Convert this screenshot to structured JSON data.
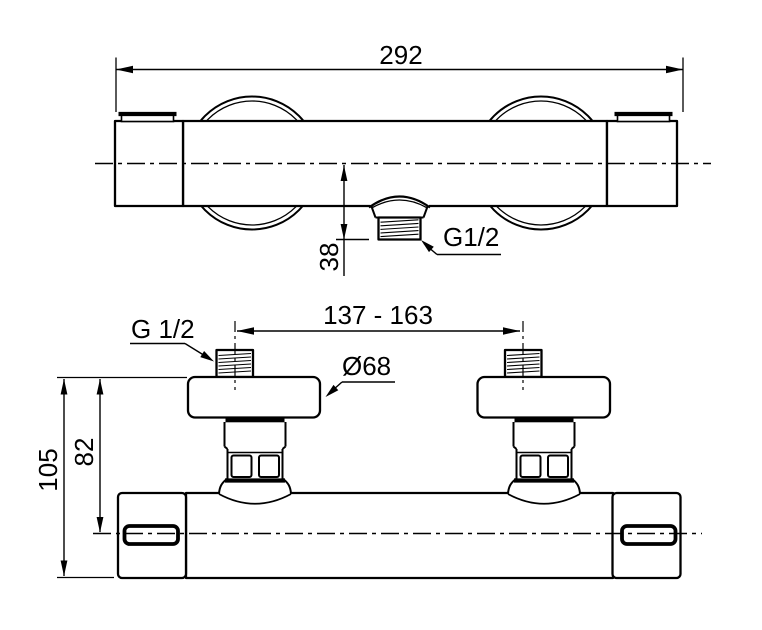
{
  "drawing": {
    "type": "technical-dimension-drawing",
    "subject": "thermostatic-shower-mixer",
    "colors": {
      "ink": "#000000",
      "paper": "#ffffff"
    },
    "front_view": {
      "dim_total_width": "292",
      "dim_outlet_offset": "38",
      "outlet_thread_label": "G1/2"
    },
    "top_view": {
      "dim_pipe_spacing": "137 - 163",
      "pipe_thread_label": "G 1/2",
      "escutcheon_diameter": "Ø68",
      "dim_depth_total": "105",
      "dim_depth_to_axis": "82"
    }
  }
}
